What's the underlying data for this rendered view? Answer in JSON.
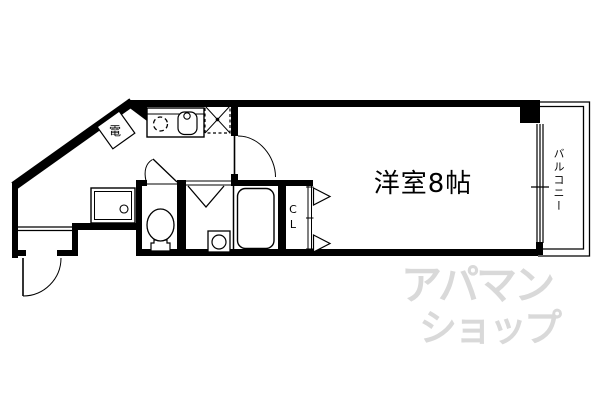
{
  "plan": {
    "rooms": {
      "main_room": "洋室8帖",
      "balcony": "バルコニー",
      "closet": "C\nL",
      "water_heater": "電"
    },
    "watermark": {
      "line1": "アパマン",
      "line2": "ショップ"
    },
    "colors": {
      "line": "#000000",
      "background": "#ffffff",
      "watermark": "#d9d9d9"
    }
  }
}
